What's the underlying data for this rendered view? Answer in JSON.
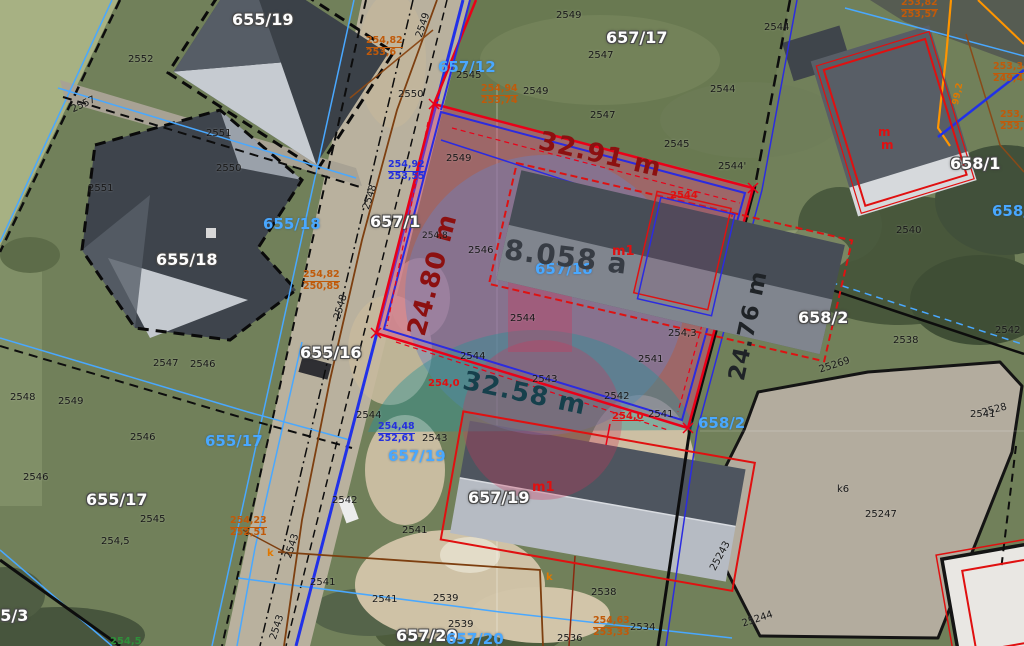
{
  "map": {
    "type": "aerial-cadastral-view",
    "subject_parcel": {
      "id": "657/18",
      "area_label": "8.058 a",
      "dim_top": "32.91 m",
      "dim_left": "24.80 m",
      "dim_bottom": "32.58 m",
      "dim_right": "24.76 m",
      "building_label": "m1"
    },
    "visible_parcels": [
      "655/19",
      "657/17",
      "655/18",
      "657/1",
      "657/12",
      "655/16",
      "655/17",
      "655/3",
      "657/18",
      "657/19",
      "657/20",
      "658/1",
      "658/2"
    ]
  },
  "colors": {
    "cyan": "#49a8ff",
    "orange": "#c05a0a",
    "dim_red": "#8c1010",
    "dim_teal": "#16404c",
    "boundary_red": "#ea0018",
    "layer_blue": "#2b2be0",
    "highlight_pink": "rgba(228,64,130,0.38)"
  },
  "map_labels": [
    {
      "t": "655/19",
      "x": 232,
      "y": 12,
      "c": "wp"
    },
    {
      "t": "657/17",
      "x": 606,
      "y": 30,
      "c": "wp"
    },
    {
      "t": "655/18",
      "x": 156,
      "y": 252,
      "c": "wp"
    },
    {
      "t": "657/1",
      "x": 370,
      "y": 214,
      "c": "wp"
    },
    {
      "t": "655/16",
      "x": 300,
      "y": 345,
      "c": "wp"
    },
    {
      "t": "655/17",
      "x": 86,
      "y": 492,
      "c": "wp"
    },
    {
      "t": "657/19",
      "x": 468,
      "y": 490,
      "c": "wp"
    },
    {
      "t": "657/20",
      "x": 396,
      "y": 628,
      "c": "wp"
    },
    {
      "t": "658/1",
      "x": 950,
      "y": 156,
      "c": "wp"
    },
    {
      "t": "658/2",
      "x": 798,
      "y": 310,
      "c": "wp"
    },
    {
      "t": "655/3",
      "x": -22,
      "y": 608,
      "c": "wp"
    },
    {
      "t": "655/18",
      "x": 263,
      "y": 217,
      "c": "cp"
    },
    {
      "t": "657/12",
      "x": 438,
      "y": 60,
      "c": "cp"
    },
    {
      "t": "655/17",
      "x": 205,
      "y": 434,
      "c": "cp"
    },
    {
      "t": "657/19",
      "x": 388,
      "y": 449,
      "c": "cp"
    },
    {
      "t": "658/2",
      "x": 698,
      "y": 416,
      "c": "cp"
    },
    {
      "t": "658/1",
      "x": 992,
      "y": 204,
      "c": "cp"
    },
    {
      "t": "657/20",
      "x": 446,
      "y": 632,
      "c": "cp"
    },
    {
      "t": "657/18",
      "x": 535,
      "y": 262,
      "c": "cp",
      "s": 15
    },
    {
      "t": "32.91 m",
      "x": 542,
      "y": 128,
      "c": "dimr",
      "r": 13
    },
    {
      "t": "24.80 m",
      "x": 404,
      "y": 332,
      "c": "dimr",
      "r": -75
    },
    {
      "t": "32.58 m",
      "x": 466,
      "y": 368,
      "c": "dimt",
      "r": 12
    },
    {
      "t": "24.76 m",
      "x": 726,
      "y": 378,
      "c": "dimk",
      "r": -78
    },
    {
      "t": "8.058 a",
      "x": 506,
      "y": 236,
      "c": "area",
      "r": 7
    },
    {
      "t": "2552",
      "x": 128,
      "y": 55,
      "c": "bk"
    },
    {
      "t": "2557",
      "x": 70,
      "y": 106,
      "c": "bk",
      "r": -25
    },
    {
      "t": "2551",
      "x": 206,
      "y": 129,
      "c": "bk"
    },
    {
      "t": "2550",
      "x": 216,
      "y": 164,
      "c": "bk"
    },
    {
      "t": "2551",
      "x": 88,
      "y": 184,
      "c": "bk"
    },
    {
      "t": "2549",
      "x": 415,
      "y": 36,
      "c": "bk",
      "r": -72
    },
    {
      "t": "2549",
      "x": 556,
      "y": 11,
      "c": "bk"
    },
    {
      "t": "2547",
      "x": 588,
      "y": 51,
      "c": "bk"
    },
    {
      "t": "2544",
      "x": 764,
      "y": 23,
      "c": "bk"
    },
    {
      "t": "2545",
      "x": 456,
      "y": 71,
      "c": "bk"
    },
    {
      "t": "2550",
      "x": 398,
      "y": 90,
      "c": "bk"
    },
    {
      "t": "2549",
      "x": 523,
      "y": 87,
      "c": "bk"
    },
    {
      "t": "2547",
      "x": 590,
      "y": 111,
      "c": "bk"
    },
    {
      "t": "2544",
      "x": 710,
      "y": 85,
      "c": "bk"
    },
    {
      "t": "2545",
      "x": 664,
      "y": 140,
      "c": "bk"
    },
    {
      "t": "2544'",
      "x": 718,
      "y": 162,
      "c": "bk"
    },
    {
      "t": "2549",
      "x": 446,
      "y": 154,
      "c": "bk"
    },
    {
      "t": "2548",
      "x": 362,
      "y": 208,
      "c": "bk",
      "r": -72
    },
    {
      "t": "254,8",
      "x": 422,
      "y": 232,
      "c": "bk",
      "s": 9
    },
    {
      "t": "2546",
      "x": 468,
      "y": 246,
      "c": "bk"
    },
    {
      "t": "2544",
      "x": 510,
      "y": 314,
      "c": "bk"
    },
    {
      "t": "2544",
      "x": 460,
      "y": 352,
      "c": "bk"
    },
    {
      "t": "2543",
      "x": 532,
      "y": 375,
      "c": "bk"
    },
    {
      "t": "254,3",
      "x": 668,
      "y": 329,
      "c": "bk"
    },
    {
      "t": "2541",
      "x": 638,
      "y": 355,
      "c": "bk"
    },
    {
      "t": "2542",
      "x": 604,
      "y": 392,
      "c": "bk"
    },
    {
      "t": "2541",
      "x": 648,
      "y": 410,
      "c": "bk"
    },
    {
      "t": "2548",
      "x": 10,
      "y": 393,
      "c": "bk"
    },
    {
      "t": "2549",
      "x": 58,
      "y": 397,
      "c": "bk"
    },
    {
      "t": "2547",
      "x": 153,
      "y": 359,
      "c": "bk"
    },
    {
      "t": "2546",
      "x": 190,
      "y": 360,
      "c": "bk"
    },
    {
      "t": "2548",
      "x": 333,
      "y": 318,
      "c": "bk",
      "r": -74
    },
    {
      "t": "2546",
      "x": 130,
      "y": 433,
      "c": "bk"
    },
    {
      "t": "2546",
      "x": 23,
      "y": 473,
      "c": "bk"
    },
    {
      "t": "2545",
      "x": 140,
      "y": 515,
      "c": "bk"
    },
    {
      "t": "254,5",
      "x": 101,
      "y": 537,
      "c": "bk"
    },
    {
      "t": "2543",
      "x": 422,
      "y": 434,
      "c": "bk"
    },
    {
      "t": "2544",
      "x": 356,
      "y": 411,
      "c": "bk"
    },
    {
      "t": "2542",
      "x": 332,
      "y": 496,
      "c": "bk"
    },
    {
      "t": "2543",
      "x": 284,
      "y": 557,
      "c": "bk",
      "r": -72
    },
    {
      "t": "2543",
      "x": 269,
      "y": 638,
      "c": "bk",
      "r": -72
    },
    {
      "t": "2541",
      "x": 402,
      "y": 526,
      "c": "bk"
    },
    {
      "t": "2541",
      "x": 310,
      "y": 578,
      "c": "bk"
    },
    {
      "t": "2541",
      "x": 372,
      "y": 595,
      "c": "bk"
    },
    {
      "t": "2539",
      "x": 433,
      "y": 594,
      "c": "bk"
    },
    {
      "t": "2539",
      "x": 448,
      "y": 620,
      "c": "bk"
    },
    {
      "t": "2538",
      "x": 591,
      "y": 588,
      "c": "bk"
    },
    {
      "t": "2536",
      "x": 557,
      "y": 634,
      "c": "bk"
    },
    {
      "t": "2534",
      "x": 630,
      "y": 623,
      "c": "bk"
    },
    {
      "t": "2538",
      "x": 893,
      "y": 336,
      "c": "bk"
    },
    {
      "t": "2542",
      "x": 995,
      "y": 326,
      "c": "bk"
    },
    {
      "t": "2541",
      "x": 970,
      "y": 410,
      "c": "bk"
    },
    {
      "t": "2540",
      "x": 896,
      "y": 226,
      "c": "bk"
    },
    {
      "t": "25247",
      "x": 865,
      "y": 510,
      "c": "bk"
    },
    {
      "t": "k6",
      "x": 837,
      "y": 485,
      "c": "bk"
    },
    {
      "t": "25269",
      "x": 818,
      "y": 366,
      "c": "bk",
      "r": -18
    },
    {
      "t": "2528",
      "x": 981,
      "y": 409,
      "c": "bk",
      "r": -15
    },
    {
      "t": "25243",
      "x": 709,
      "y": 568,
      "c": "bk",
      "r": -62
    },
    {
      "t": "25244",
      "x": 741,
      "y": 620,
      "c": "bk",
      "r": -18
    },
    {
      "t": "2544",
      "x": 670,
      "y": 191,
      "c": "rd"
    },
    {
      "t": "m1",
      "x": 612,
      "y": 245,
      "c": "rd",
      "s": 13
    },
    {
      "t": "m1",
      "x": 532,
      "y": 481,
      "c": "rd",
      "s": 13
    },
    {
      "t": "254,0",
      "x": 612,
      "y": 412,
      "c": "rd u"
    },
    {
      "t": "254,0",
      "x": 428,
      "y": 379,
      "c": "rd"
    },
    {
      "t": "m",
      "x": 878,
      "y": 126,
      "c": "rd",
      "s": 12
    },
    {
      "t": "m",
      "x": 881,
      "y": 139,
      "c": "rd",
      "s": 12
    },
    {
      "t": "k",
      "x": 267,
      "y": 549,
      "c": "ok"
    },
    {
      "t": "k",
      "x": 546,
      "y": 573,
      "c": "ok"
    },
    {
      "t": "99,2",
      "x": 952,
      "y": 104,
      "c": "ok",
      "r": -78,
      "s": 9
    },
    {
      "t": "254,5",
      "x": 110,
      "y": 637,
      "c": "gr"
    }
  ],
  "fractions": [
    {
      "a": "254,82",
      "b": "253,6",
      "x": 366,
      "y": 36,
      "c": "or"
    },
    {
      "a": "254,94",
      "b": "253,74",
      "x": 481,
      "y": 84,
      "c": "or"
    },
    {
      "a": "254,82",
      "b": "250,85",
      "x": 303,
      "y": 270,
      "c": "or"
    },
    {
      "a": "254,23",
      "b": "252,51",
      "x": 230,
      "y": 516,
      "c": "or"
    },
    {
      "a": "254,63",
      "b": "253,33",
      "x": 593,
      "y": 616,
      "c": "or"
    },
    {
      "a": "253,82",
      "b": "253,57",
      "x": 901,
      "y": -2,
      "c": "or"
    },
    {
      "a": "253,34",
      "b": "249,45",
      "x": 993,
      "y": 62,
      "c": "or"
    },
    {
      "a": "253,8",
      "b": "253,9",
      "x": 1000,
      "y": 110,
      "c": "or"
    },
    {
      "a": "254,92",
      "b": "253,55",
      "x": 388,
      "y": 160,
      "c": "bl"
    },
    {
      "a": "254,48",
      "b": "252,61",
      "x": 378,
      "y": 422,
      "c": "bl"
    }
  ]
}
